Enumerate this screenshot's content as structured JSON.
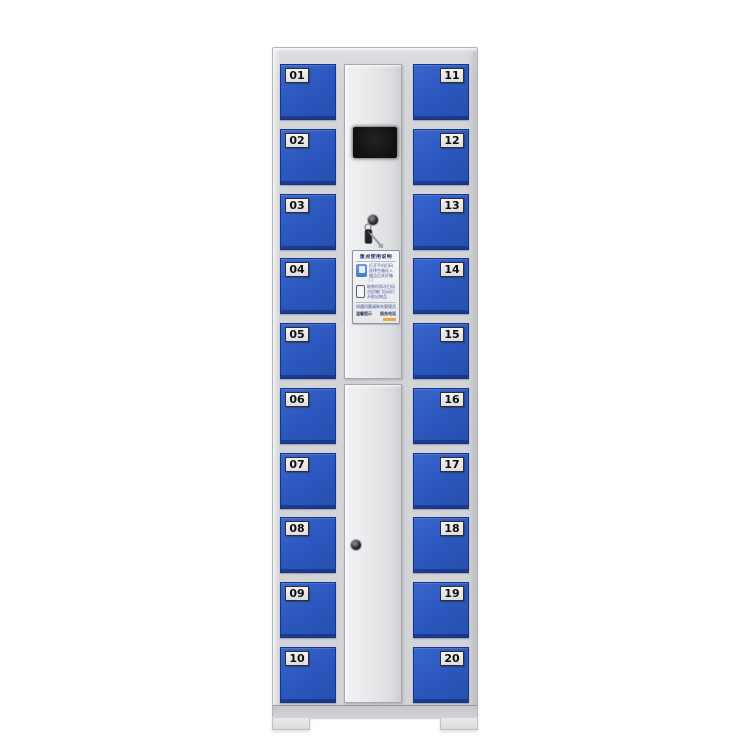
{
  "colors": {
    "background": "#ffffff",
    "frame_gray": "#d3d4d7",
    "door_blue": "#2c58c0",
    "door_blue_dark": "#16338c",
    "center_panel_gray": "#e8e9eb",
    "plate_bg": "#e8e9eb",
    "plate_text": "#0f0f10",
    "screen_black": "#141414",
    "sticker_accent_orange": "#e7a93c"
  },
  "doors": {
    "left": [
      "01",
      "02",
      "03",
      "04",
      "05",
      "06",
      "07",
      "08",
      "09",
      "10"
    ],
    "right": [
      "11",
      "12",
      "13",
      "14",
      "15",
      "16",
      "17",
      "18",
      "19",
      "20"
    ]
  },
  "control": {
    "sticker": {
      "title": "重点使用说明",
      "step1": "打开手机扫码选择空箱存入物品后关好箱门",
      "step2": "取物时再次扫码对应箱门自动打开取出物品",
      "note": "如遇问题请联系管理员",
      "footer_left": "温馨提示",
      "footer_right": "服务电话"
    }
  }
}
